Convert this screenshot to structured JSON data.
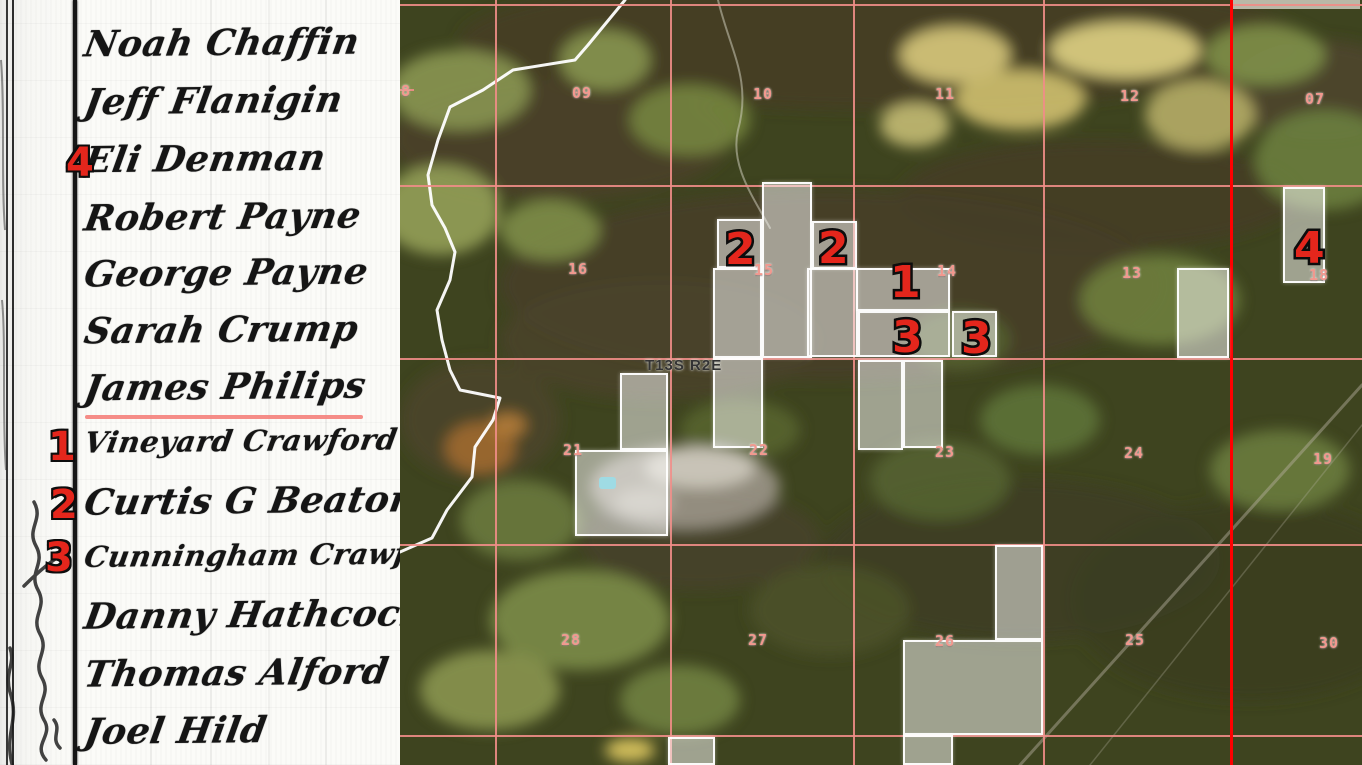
{
  "document": {
    "names": [
      {
        "text": "Noah Chaffin",
        "y": 22
      },
      {
        "text": "Jeff Flanigin",
        "y": 80
      },
      {
        "text": "Eli Denman",
        "y": 138
      },
      {
        "text": "Robert Payne",
        "y": 196
      },
      {
        "text": "George Payne",
        "y": 252
      },
      {
        "text": "Sarah Crump",
        "y": 309
      },
      {
        "text": "James Philips",
        "y": 366
      },
      {
        "text": "Vineyard Crawford",
        "y": 424
      },
      {
        "text": "Curtis G Beaton",
        "y": 480
      },
      {
        "text": "Cunningham Crawford",
        "y": 538
      },
      {
        "text": "Danny Hathcock",
        "y": 594
      },
      {
        "text": "Thomas Alford",
        "y": 652
      },
      {
        "text": "Joel Hild",
        "y": 710
      }
    ],
    "red_numbers": [
      {
        "label": "4",
        "x": 66,
        "y": 143
      },
      {
        "label": "1",
        "x": 48,
        "y": 427
      },
      {
        "label": "2",
        "x": 50,
        "y": 485
      },
      {
        "label": "3",
        "x": 45,
        "y": 538
      }
    ],
    "underline": {
      "x": 85,
      "y": 415,
      "width": 278
    }
  },
  "map": {
    "township_label": "T13S R2E",
    "township_label_pos": {
      "x": 245,
      "y": 357
    },
    "grid": {
      "v_lines": [
        95,
        270,
        453,
        643
      ],
      "h_lines": [
        4,
        185,
        358,
        544,
        735
      ],
      "range_line_x": 830,
      "edge_segment": {
        "x": 0,
        "y": 89,
        "w": 14
      }
    },
    "sections": [
      {
        "label": "08",
        "x": -9,
        "y": 82
      },
      {
        "label": "09",
        "x": 172,
        "y": 84
      },
      {
        "label": "10",
        "x": 353,
        "y": 85
      },
      {
        "label": "11",
        "x": 535,
        "y": 85
      },
      {
        "label": "12",
        "x": 720,
        "y": 87
      },
      {
        "label": "07",
        "x": 905,
        "y": 90
      },
      {
        "label": "16",
        "x": 168,
        "y": 260
      },
      {
        "label": "15",
        "x": 354,
        "y": 261
      },
      {
        "label": "14",
        "x": 537,
        "y": 262
      },
      {
        "label": "13",
        "x": 722,
        "y": 264
      },
      {
        "label": "18",
        "x": 909,
        "y": 266
      },
      {
        "label": "21",
        "x": 163,
        "y": 441
      },
      {
        "label": "22",
        "x": 349,
        "y": 441
      },
      {
        "label": "23",
        "x": 535,
        "y": 443
      },
      {
        "label": "24",
        "x": 724,
        "y": 444
      },
      {
        "label": "19",
        "x": 913,
        "y": 450
      },
      {
        "label": "28",
        "x": 161,
        "y": 631
      },
      {
        "label": "27",
        "x": 348,
        "y": 631
      },
      {
        "label": "26",
        "x": 535,
        "y": 632
      },
      {
        "label": "25",
        "x": 725,
        "y": 631
      },
      {
        "label": "30",
        "x": 919,
        "y": 634
      }
    ],
    "markers": [
      {
        "label": "2",
        "x": 325,
        "y": 228
      },
      {
        "label": "2",
        "x": 418,
        "y": 227
      },
      {
        "label": "1",
        "x": 490,
        "y": 261
      },
      {
        "label": "3",
        "x": 492,
        "y": 316
      },
      {
        "label": "3",
        "x": 561,
        "y": 317
      },
      {
        "label": "4",
        "x": 894,
        "y": 227
      }
    ],
    "parcels": [
      {
        "x": 317,
        "y": 219,
        "w": 45,
        "h": 49
      },
      {
        "x": 362,
        "y": 182,
        "w": 50,
        "h": 176
      },
      {
        "x": 412,
        "y": 221,
        "w": 45,
        "h": 48
      },
      {
        "x": 313,
        "y": 268,
        "w": 49,
        "h": 90
      },
      {
        "x": 407,
        "y": 268,
        "w": 51,
        "h": 89
      },
      {
        "x": 456,
        "y": 268,
        "w": 94,
        "h": 43
      },
      {
        "x": 458,
        "y": 311,
        "w": 92,
        "h": 46
      },
      {
        "x": 552,
        "y": 311,
        "w": 45,
        "h": 46
      },
      {
        "x": 458,
        "y": 360,
        "w": 45,
        "h": 90
      },
      {
        "x": 503,
        "y": 360,
        "w": 40,
        "h": 88
      },
      {
        "x": 313,
        "y": 358,
        "w": 50,
        "h": 90
      },
      {
        "x": 220,
        "y": 373,
        "w": 48,
        "h": 77
      },
      {
        "x": 175,
        "y": 450,
        "w": 93,
        "h": 86
      },
      {
        "x": 777,
        "y": 268,
        "w": 52,
        "h": 90
      },
      {
        "x": 883,
        "y": 187,
        "w": 42,
        "h": 96
      },
      {
        "x": 595,
        "y": 545,
        "w": 48,
        "h": 95
      },
      {
        "x": 503,
        "y": 640,
        "w": 140,
        "h": 95
      },
      {
        "x": 503,
        "y": 735,
        "w": 50,
        "h": 30
      },
      {
        "x": 268,
        "y": 737,
        "w": 47,
        "h": 28
      }
    ],
    "colors": {
      "grid_pink": "#ef8d87",
      "section_text": "#f2988e",
      "range_red": "#ff0000",
      "marker_red": "#e4261c",
      "underline_salmon": "#f58f85",
      "parcel_fill": "rgba(255,255,255,0.5)"
    }
  }
}
